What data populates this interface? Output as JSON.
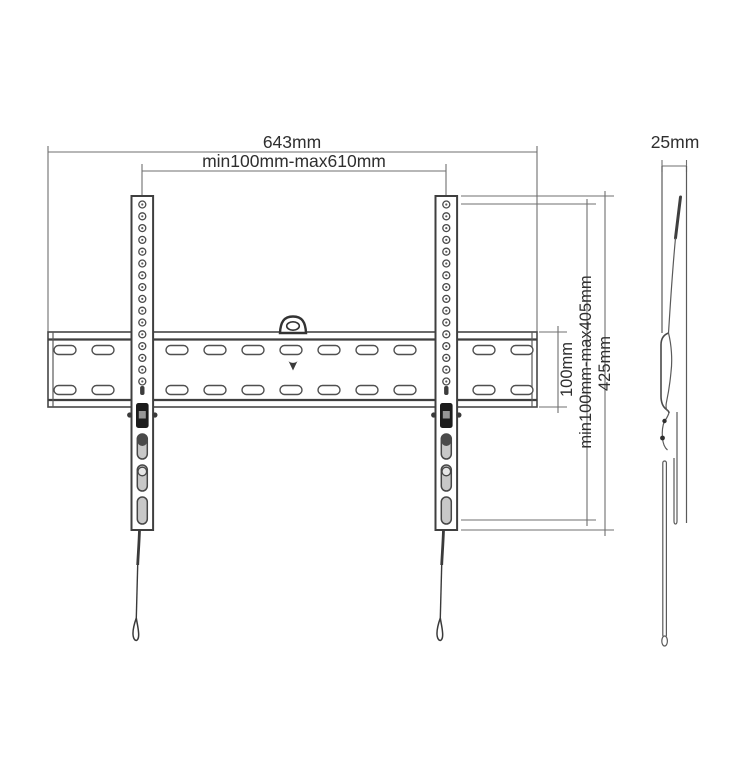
{
  "diagram": {
    "subject": "wall-mount-bracket-technical-drawing",
    "views": {
      "front": "front-view",
      "side": "side-view"
    },
    "front_view": {
      "dim_overall_width": "643mm",
      "dim_vesa_width_range": "min100mm-max610mm",
      "dim_plate_height": "100mm",
      "dim_vesa_height_range": "min100mm-max405mm",
      "dim_arm_height": "425mm"
    },
    "side_view": {
      "dim_depth": "25mm"
    },
    "colors": {
      "background": "#ffffff",
      "object_line": "#474747",
      "dimension_line": "#6f6f6f",
      "text": "#2f2f2f",
      "latch_dark": "#1c1c1c",
      "slot_gray": "#c8c8c8"
    }
  }
}
